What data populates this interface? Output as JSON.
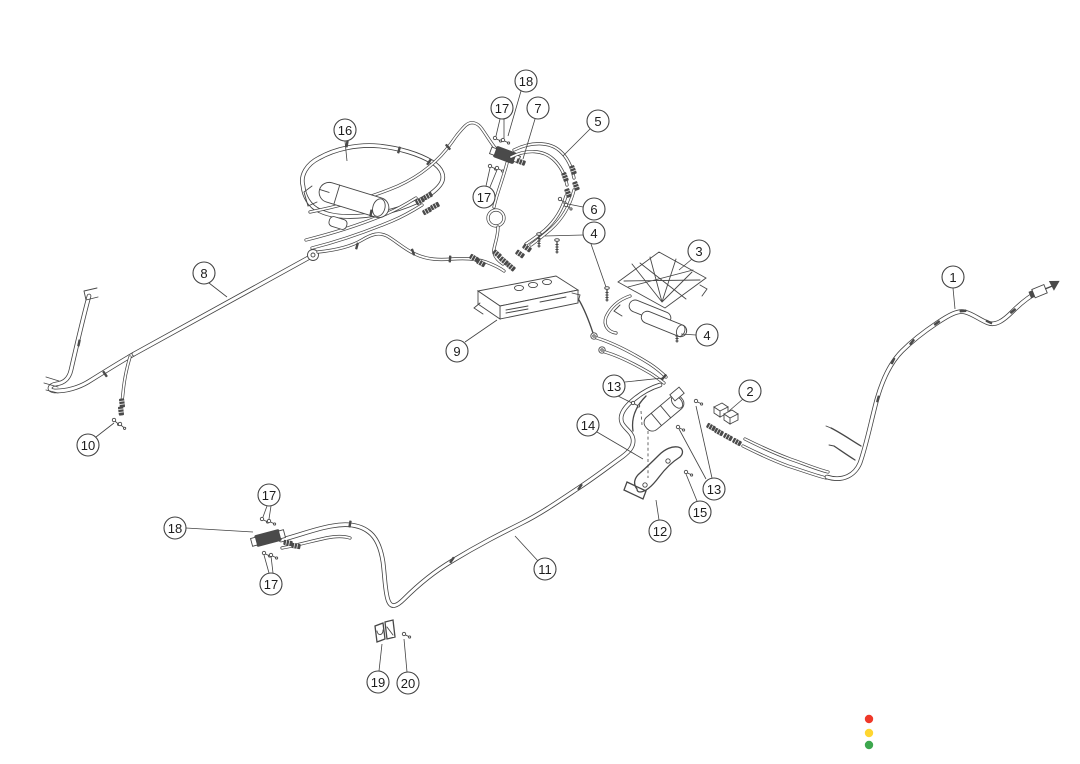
{
  "diagram": {
    "background": "#ffffff",
    "line_color": "#424242",
    "callouts": [
      {
        "n": "1",
        "x": 953,
        "y": 277,
        "lines": [
          [
            953,
            288,
            955,
            309
          ]
        ]
      },
      {
        "n": "2",
        "x": 750,
        "y": 391,
        "lines": [
          [
            743,
            399,
            729,
            411
          ]
        ]
      },
      {
        "n": "3",
        "x": 699,
        "y": 251,
        "lines": [
          [
            692,
            259,
            679,
            270
          ]
        ]
      },
      {
        "n": "4",
        "x": 594,
        "y": 233,
        "lines": [
          [
            583,
            235,
            545,
            236
          ],
          [
            591,
            244,
            606,
            287
          ]
        ]
      },
      {
        "n": "4",
        "x": 707,
        "y": 335,
        "lines": [
          [
            696,
            335,
            681,
            334
          ]
        ]
      },
      {
        "n": "5",
        "x": 598,
        "y": 121,
        "lines": [
          [
            590,
            129,
            563,
            156
          ]
        ]
      },
      {
        "n": "6",
        "x": 594,
        "y": 209,
        "lines": [
          [
            583,
            207,
            568,
            204
          ]
        ]
      },
      {
        "n": "7",
        "x": 538,
        "y": 108,
        "lines": [
          [
            535,
            119,
            523,
            159
          ]
        ]
      },
      {
        "n": "8",
        "x": 204,
        "y": 273,
        "lines": [
          [
            209,
            283,
            227,
            297
          ]
        ]
      },
      {
        "n": "9",
        "x": 457,
        "y": 351,
        "lines": [
          [
            465,
            342,
            497,
            320
          ]
        ]
      },
      {
        "n": "10",
        "x": 88,
        "y": 445,
        "lines": [
          [
            96,
            437,
            114,
            423
          ]
        ]
      },
      {
        "n": "11",
        "x": 545,
        "y": 569,
        "lines": [
          [
            538,
            561,
            515,
            536
          ]
        ]
      },
      {
        "n": "12",
        "x": 660,
        "y": 531,
        "lines": [
          [
            659,
            520,
            656,
            500
          ]
        ]
      },
      {
        "n": "13",
        "x": 614,
        "y": 386,
        "lines": [
          [
            625,
            382,
            663,
            378
          ],
          [
            618,
            396,
            632,
            403
          ]
        ]
      },
      {
        "n": "13",
        "x": 714,
        "y": 489,
        "lines": [
          [
            712,
            478,
            696,
            406
          ],
          [
            706,
            479,
            679,
            429
          ]
        ]
      },
      {
        "n": "14",
        "x": 588,
        "y": 425,
        "lines": [
          [
            597,
            432,
            643,
            459
          ]
        ]
      },
      {
        "n": "15",
        "x": 700,
        "y": 512,
        "lines": [
          [
            697,
            501,
            686,
            474
          ]
        ]
      },
      {
        "n": "16",
        "x": 345,
        "y": 130,
        "lines": [
          [
            345,
            141,
            347,
            161
          ]
        ]
      },
      {
        "n": "17",
        "x": 502,
        "y": 108,
        "lines": [
          [
            500,
            119,
            496,
            136
          ],
          [
            504,
            119,
            504,
            138
          ]
        ]
      },
      {
        "n": "17",
        "x": 484,
        "y": 197,
        "lines": [
          [
            486,
            186,
            490,
            168
          ],
          [
            490,
            187,
            497,
            170
          ]
        ]
      },
      {
        "n": "17",
        "x": 269,
        "y": 495,
        "lines": [
          [
            267,
            506,
            263,
            517
          ],
          [
            271,
            506,
            269,
            519
          ]
        ]
      },
      {
        "n": "17",
        "x": 271,
        "y": 584,
        "lines": [
          [
            269,
            573,
            264,
            555
          ],
          [
            273,
            573,
            271,
            556
          ]
        ]
      },
      {
        "n": "18",
        "x": 526,
        "y": 81,
        "lines": [
          [
            521,
            91,
            508,
            136
          ]
        ]
      },
      {
        "n": "18",
        "x": 175,
        "y": 528,
        "lines": [
          [
            186,
            528,
            253,
            532
          ]
        ]
      },
      {
        "n": "19",
        "x": 378,
        "y": 682,
        "lines": [
          [
            379,
            671,
            382,
            644
          ]
        ]
      },
      {
        "n": "20",
        "x": 408,
        "y": 683,
        "lines": [
          [
            407,
            672,
            404,
            639
          ]
        ]
      }
    ],
    "indicator_dots": [
      {
        "name": "red",
        "color": "#ef3829",
        "x": 869,
        "y": 719
      },
      {
        "name": "yellow",
        "color": "#ffd630",
        "x": 869,
        "y": 733
      },
      {
        "name": "green",
        "color": "#3da74e",
        "x": 869,
        "y": 745
      }
    ]
  }
}
